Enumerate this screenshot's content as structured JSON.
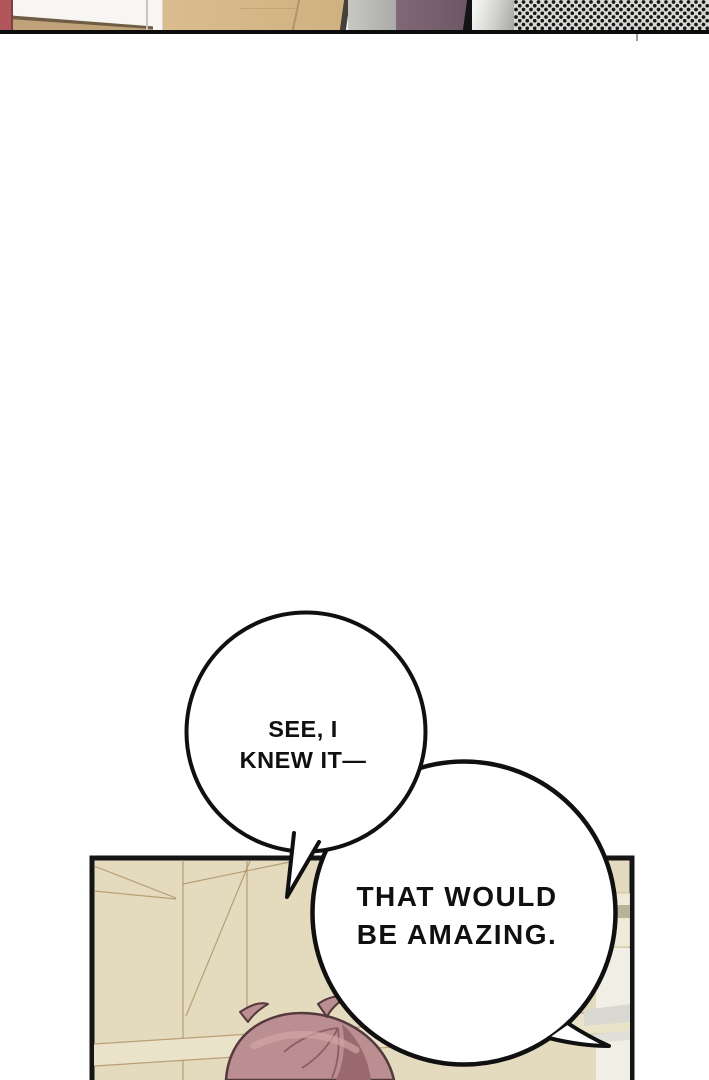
{
  "page": {
    "type": "webtoon comic page segment",
    "panel_count_visible": 2
  },
  "bubbles": {
    "bubble1": {
      "line1": "SEE, I",
      "line2": "KNEW IT—"
    },
    "bubble2": {
      "line1": "THAT WOULD",
      "line2": "BE AMAZING."
    }
  },
  "colors": {
    "background": "#ffffff",
    "ink": "#101010",
    "bubble_fill": "#ffffff",
    "panel_border": "#151515",
    "panel_wall_beige": "#e4dabd",
    "band_beige": "#ebe2ca",
    "right_object_white": "#f0eee5",
    "wood_tan": "#d3b485",
    "wall_red": "#b1565b",
    "wall_gray": "#bcbbb7",
    "wall_purple": "#7a6270",
    "halftone_bg": "#d8d8d5",
    "hair_base": "#bb8e91",
    "hair_shadow": "#99696e",
    "hair_highlight": "#d4a9a8",
    "hair_outline": "#54393d"
  }
}
